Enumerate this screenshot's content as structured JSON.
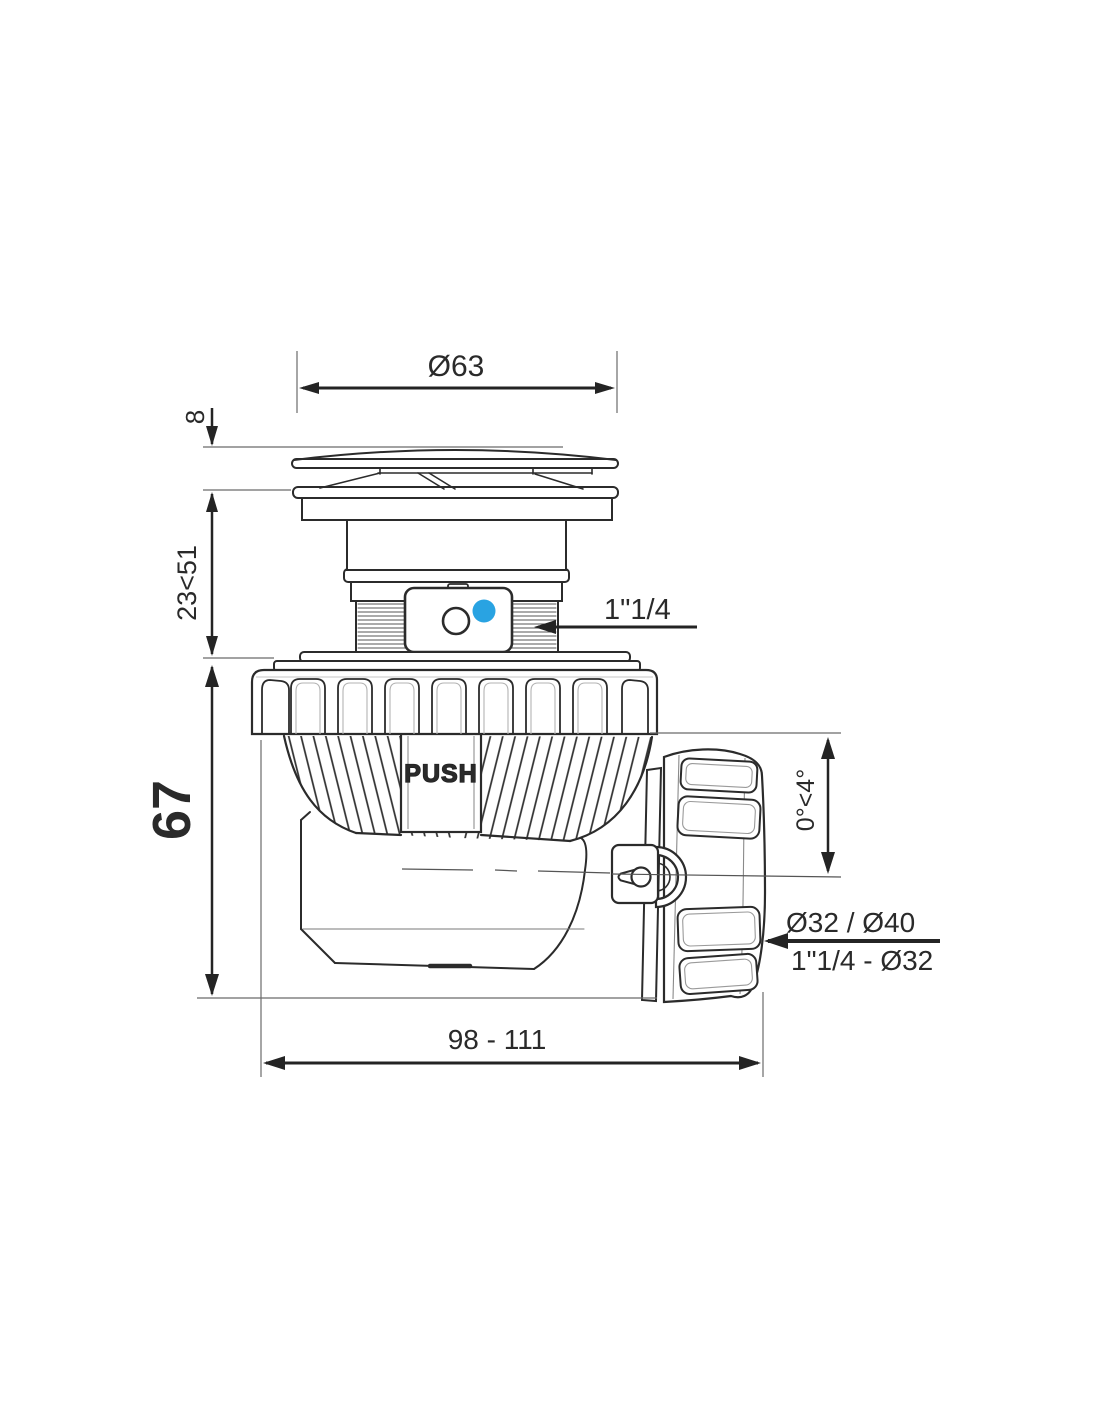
{
  "page": {
    "background": "#ffffff",
    "width": 1100,
    "height": 1422
  },
  "drawing": {
    "type": "technical-dimension-drawing",
    "subject": "push-open waste trap (siphon), side elevation",
    "colors": {
      "line": "#2b2b2b",
      "dimension": "#242424",
      "thin_reference": "#6b6b6b",
      "accent_blue": "#29a3e2",
      "background": "#ffffff"
    },
    "labels": {
      "cap_diameter": "Ø63",
      "cap_height": "8",
      "install_height": "23<51",
      "body_height": "67",
      "inlet_thread": "1\"1/4",
      "outlet_angle": "0°<4°",
      "outlet_diameters": "Ø32 / Ø40",
      "outlet_adapters": "1\"1/4 - Ø32",
      "overall_length": "98 - 111",
      "push_marking": "PUSH"
    }
  }
}
